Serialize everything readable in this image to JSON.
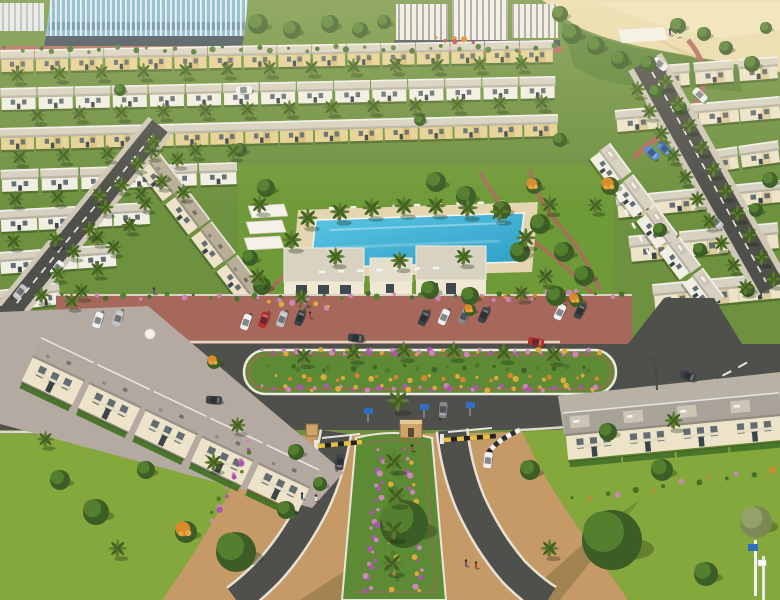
{
  "scene": {
    "label": "aerial-villa-community-render",
    "palette": {
      "sand": "#ead9ab",
      "slope": "#5c8336",
      "lawnBase": "#6e9140",
      "lawnBright": "#85a83d",
      "parkLawn": "#6f9a38",
      "asphalt": "#4f4f4b",
      "brick": "#a5685a",
      "walkRed": "#b06a5e",
      "sidewalk": "#dfd9ca",
      "roadLine": "#eae8de",
      "deck": "#e3d6b0",
      "pool1": "#5cc6e4",
      "pool2": "#2d9ec7",
      "facadeYellow": "#e5d193",
      "facadeCream": "#ece3c8",
      "facadeWhite": "#f1eee3",
      "roofPale": "#d7d1c1",
      "roofGray": "#a9a298",
      "roofTan": "#b9ae96",
      "roofMauve": "#b3a8a0",
      "glass": "#79b2d6",
      "fin": "#eef3f5",
      "winDark": "#55626b",
      "trunk": "#7a6148",
      "palm1": "#5d7c33",
      "palm2": "#42611f",
      "hedge": "#4a762c",
      "flPink": "#cd86bc",
      "flPurple": "#a958ae",
      "flYellow": "#dcab3c",
      "flOrange": "#d8862e",
      "flRed": "#bf4a42",
      "gateYellow": "#e6bf3e",
      "pathTan": "#c69a66",
      "boothTan": "#cfa36a",
      "signBlue": "#2f6fbc",
      "medianGreen": "#5d8a35",
      "carWhite": "#eef0f1",
      "carSilver": "#c0c4c6",
      "carGray": "#85898c",
      "carDark": "#3e4347",
      "carRed": "#b5302d",
      "carBlue": "#4f86d8"
    },
    "rowStyles": {
      "yellow": {
        "roof": "roofPale",
        "facade": "facadeYellow",
        "rh": 10,
        "fh": 12,
        "accent": true
      },
      "white": {
        "roof": "roofPale",
        "facade": "facadeWhite",
        "rh": 10,
        "fh": 12
      },
      "cream": {
        "roof": "roofPale",
        "facade": "facadeCream",
        "rh": 10,
        "fh": 12,
        "accent": true
      },
      "creamBig": {
        "roof": "roofPale",
        "facade": "facadeCream",
        "rh": 12,
        "fh": 14,
        "accent": true
      },
      "tanRow": {
        "roof": "roofTan",
        "facade": "facadeCream",
        "rh": 15,
        "fh": 12,
        "ac": true
      },
      "whiteRow": {
        "roof": "roofPale",
        "facade": "facadeWhite",
        "rh": 14,
        "fh": 12,
        "deck": true
      },
      "villaL": {
        "roof": "roofMauve",
        "facade": "facadeCream",
        "rh": 22,
        "fh": 26,
        "ac": true,
        "balcony": true,
        "hedge": true
      },
      "villaR": {
        "roof": "roofGray",
        "facade": "facadeCream",
        "rh": 24,
        "fh": 24,
        "deck": true,
        "balcony": true,
        "hedge": true
      }
    },
    "housingRows": [
      [
        0,
        60,
        554,
        50,
        34,
        "yellow"
      ],
      [
        648,
        76,
        780,
        66,
        40,
        "cream"
      ],
      [
        0,
        98,
        556,
        86,
        36,
        "white"
      ],
      [
        616,
        120,
        780,
        106,
        42,
        "cream"
      ],
      [
        0,
        138,
        558,
        124,
        35,
        "yellow"
      ],
      [
        698,
        162,
        780,
        150,
        40,
        "cream"
      ],
      [
        0,
        180,
        238,
        172,
        38,
        "white"
      ],
      [
        618,
        206,
        780,
        190,
        44,
        "cream"
      ],
      [
        0,
        220,
        150,
        212,
        38,
        "white"
      ],
      [
        628,
        248,
        780,
        234,
        48,
        "creamBig"
      ],
      [
        0,
        262,
        116,
        254,
        40,
        "white"
      ],
      [
        654,
        296,
        780,
        284,
        44,
        "creamBig"
      ],
      [
        148,
        162,
        276,
        330,
        40,
        "tanRow"
      ],
      [
        598,
        150,
        714,
        306,
        36,
        "whiteRow"
      ],
      [
        0,
        300,
        60,
        292,
        30,
        "white"
      ]
    ],
    "foregroundRows": [
      [
        30,
        356,
        312,
        490,
        58,
        "villaL"
      ],
      [
        566,
        436,
        780,
        416,
        56,
        "villaR"
      ]
    ],
    "palms": [
      [
        16,
        82
      ],
      [
        58,
        80
      ],
      [
        100,
        79
      ],
      [
        142,
        78
      ],
      [
        184,
        77
      ],
      [
        226,
        76
      ],
      [
        268,
        75
      ],
      [
        310,
        74
      ],
      [
        352,
        73
      ],
      [
        394,
        72
      ],
      [
        436,
        72
      ],
      [
        478,
        71
      ],
      [
        520,
        70
      ],
      [
        36,
        122
      ],
      [
        78,
        120
      ],
      [
        120,
        119
      ],
      [
        162,
        118
      ],
      [
        204,
        117
      ],
      [
        246,
        116
      ],
      [
        288,
        115
      ],
      [
        330,
        114
      ],
      [
        372,
        113
      ],
      [
        414,
        112
      ],
      [
        456,
        111
      ],
      [
        498,
        110
      ],
      [
        540,
        109
      ],
      [
        18,
        164
      ],
      [
        62,
        162
      ],
      [
        106,
        160
      ],
      [
        150,
        158
      ],
      [
        194,
        157
      ],
      [
        232,
        158
      ],
      [
        14,
        206
      ],
      [
        56,
        204
      ],
      [
        98,
        202
      ],
      [
        140,
        200
      ],
      [
        182,
        199
      ],
      [
        12,
        248
      ],
      [
        54,
        246
      ],
      [
        96,
        244
      ],
      [
        306,
        226,
        1.2
      ],
      [
        338,
        220,
        1.2
      ],
      [
        370,
        216,
        1.2
      ],
      [
        402,
        214,
        1.2
      ],
      [
        434,
        214,
        1.2
      ],
      [
        466,
        216,
        1.2
      ],
      [
        498,
        220,
        1.2
      ],
      [
        290,
        248,
        1.2
      ],
      [
        524,
        246,
        1.2
      ],
      [
        334,
        264,
        1.1
      ],
      [
        398,
        268,
        1.1
      ],
      [
        462,
        264,
        1.1
      ],
      [
        258,
        212,
        1.1
      ],
      [
        548,
        212,
        1.1
      ],
      [
        256,
        284,
        1.1
      ],
      [
        544,
        284,
        1.1
      ],
      [
        594,
        212
      ],
      [
        302,
        364,
        1.1
      ],
      [
        352,
        360,
        1.1
      ],
      [
        402,
        358,
        1.1
      ],
      [
        452,
        358,
        1.1
      ],
      [
        502,
        360,
        1.1
      ],
      [
        552,
        362,
        1.1
      ],
      [
        392,
        470,
        1.25
      ],
      [
        394,
        504,
        1.25
      ],
      [
        392,
        538,
        1.3
      ],
      [
        390,
        572,
        1.3
      ],
      [
        396,
        410,
        1.35
      ],
      [
        152,
        148
      ],
      [
        136,
        170
      ],
      [
        120,
        192
      ],
      [
        104,
        214
      ],
      [
        88,
        236
      ],
      [
        72,
        258
      ],
      [
        56,
        280
      ],
      [
        40,
        302
      ],
      [
        176,
        166
      ],
      [
        160,
        188
      ],
      [
        144,
        210
      ],
      [
        128,
        232
      ],
      [
        112,
        254
      ],
      [
        96,
        276
      ],
      [
        80,
        298
      ],
      [
        636,
        96
      ],
      [
        648,
        118
      ],
      [
        660,
        140
      ],
      [
        672,
        162
      ],
      [
        684,
        184
      ],
      [
        696,
        206
      ],
      [
        708,
        228
      ],
      [
        720,
        250
      ],
      [
        732,
        272
      ],
      [
        744,
        294
      ],
      [
        664,
        88
      ],
      [
        676,
        110
      ],
      [
        688,
        132
      ],
      [
        700,
        154
      ],
      [
        712,
        176
      ],
      [
        724,
        198
      ],
      [
        736,
        220
      ],
      [
        748,
        242
      ],
      [
        760,
        264
      ],
      [
        772,
        286
      ],
      [
        70,
        308
      ],
      [
        300,
        304
      ],
      [
        520,
        300
      ],
      [
        236,
        432
      ],
      [
        44,
        446
      ],
      [
        212,
        470,
        1.1
      ],
      [
        116,
        556,
        1.1
      ],
      [
        548,
        556,
        1.1
      ],
      [
        672,
        428,
        1.1
      ]
    ],
    "trees": [
      [
        572,
        34,
        10
      ],
      [
        596,
        46,
        9
      ],
      [
        620,
        60,
        9
      ],
      [
        648,
        64,
        8
      ],
      [
        678,
        26,
        8
      ],
      [
        704,
        34,
        7
      ],
      [
        726,
        48,
        7
      ],
      [
        752,
        64,
        8
      ],
      [
        766,
        28,
        6
      ],
      [
        560,
        14,
        8
      ],
      [
        258,
        24,
        10
      ],
      [
        292,
        30,
        9
      ],
      [
        330,
        24,
        9
      ],
      [
        360,
        30,
        8
      ],
      [
        384,
        22,
        7
      ],
      [
        266,
        188,
        9
      ],
      [
        436,
        182,
        10
      ],
      [
        466,
        196,
        10
      ],
      [
        502,
        210,
        9
      ],
      [
        540,
        224,
        10
      ],
      [
        520,
        252,
        10
      ],
      [
        564,
        252,
        10
      ],
      [
        584,
        276,
        10
      ],
      [
        556,
        296,
        10
      ],
      [
        470,
        296,
        9
      ],
      [
        430,
        290,
        9
      ],
      [
        262,
        286,
        9
      ],
      [
        250,
        258,
        8
      ],
      [
        610,
        186,
        9,
        "o"
      ],
      [
        534,
        186,
        8,
        "o"
      ],
      [
        576,
        300,
        7,
        "o"
      ],
      [
        470,
        310,
        6,
        "o"
      ],
      [
        214,
        362,
        7,
        "o"
      ],
      [
        240,
        150,
        7
      ],
      [
        560,
        140,
        7
      ],
      [
        120,
        90,
        6
      ],
      [
        420,
        120,
        6
      ],
      [
        660,
        230,
        7
      ],
      [
        700,
        250,
        7
      ],
      [
        748,
        290,
        7
      ],
      [
        770,
        180,
        8
      ],
      [
        756,
        210,
        7
      ],
      [
        656,
        92,
        7
      ],
      [
        680,
        108,
        7
      ],
      [
        404,
        524,
        24
      ],
      [
        612,
        540,
        30
      ],
      [
        236,
        552,
        20
      ],
      [
        96,
        512,
        13
      ],
      [
        60,
        480,
        10
      ],
      [
        146,
        470,
        9
      ],
      [
        186,
        532,
        11,
        "o"
      ],
      [
        756,
        522,
        16,
        "olive"
      ],
      [
        706,
        574,
        12
      ],
      [
        662,
        470,
        11
      ],
      [
        530,
        470,
        10
      ],
      [
        286,
        510,
        9
      ],
      [
        320,
        484,
        7
      ],
      [
        296,
        452,
        8
      ],
      [
        608,
        432,
        9
      ]
    ],
    "flowerStrips": [
      [
        266,
        352,
        598,
        352,
        44,
        [
          "flPink",
          "flPurple",
          "flPink",
          "flYellow"
        ]
      ],
      [
        272,
        368,
        592,
        368,
        34,
        [
          "#4e7a2e",
          "#5d8a35",
          "#3f6526"
        ]
      ],
      [
        280,
        378,
        596,
        378,
        30,
        [
          "flYellow",
          "flOrange"
        ]
      ],
      [
        266,
        388,
        598,
        388,
        40,
        [
          "flPink",
          "flPurple",
          "flYellow"
        ]
      ],
      [
        382,
        452,
        368,
        592,
        26,
        [
          "flPink",
          "flPurple"
        ]
      ],
      [
        408,
        452,
        420,
        592,
        24,
        [
          "flPurple",
          "flPink",
          "flYellow"
        ]
      ],
      [
        394,
        460,
        394,
        588,
        18,
        [
          "#4e7a2e",
          "flYellow"
        ]
      ],
      [
        252,
        444,
        212,
        520,
        16,
        [
          "flPink",
          "flPurple",
          "#4e7a2e"
        ]
      ],
      [
        66,
        297,
        624,
        295,
        40,
        [
          "#44702a",
          "#558034",
          "flPink"
        ]
      ],
      [
        486,
        300,
        580,
        292,
        12,
        [
          "flOrange",
          "flPink"
        ]
      ],
      [
        262,
        300,
        330,
        308,
        10,
        [
          "flPink",
          "flYellow"
        ]
      ],
      [
        576,
        500,
        770,
        470,
        14,
        [
          "#44702a",
          "flOrange",
          "#44702a",
          "flPink"
        ]
      ],
      [
        8,
        50,
        552,
        48,
        36,
        [
          "#44702a",
          "#558034"
        ]
      ],
      [
        440,
        40,
        470,
        40,
        6,
        [
          "flOrange",
          "flRed"
        ]
      ]
    ],
    "deckItems": [
      [
        332,
        208,
        502,
        202,
        9
      ],
      [
        322,
        272,
        436,
        268,
        7
      ],
      [
        612,
        186,
        648,
        252,
        6
      ]
    ],
    "cars": [
      [
        98,
        320,
        -72,
        "carWhite"
      ],
      [
        118,
        318,
        -72,
        "carSilver"
      ],
      [
        246,
        322,
        -70,
        "carWhite"
      ],
      [
        264,
        320,
        -70,
        "carRed"
      ],
      [
        282,
        319,
        -70,
        "carSilver"
      ],
      [
        300,
        318,
        -70,
        "carDark"
      ],
      [
        424,
        318,
        -66,
        "carDark"
      ],
      [
        444,
        317,
        -66,
        "carWhite"
      ],
      [
        464,
        316,
        -66,
        "carGray"
      ],
      [
        484,
        315,
        -66,
        "carDark"
      ],
      [
        560,
        312,
        -64,
        "carWhite"
      ],
      [
        580,
        311,
        -64,
        "carDark"
      ],
      [
        356,
        338,
        6,
        "carDark"
      ],
      [
        536,
        342,
        10,
        "carRed"
      ],
      [
        214,
        400,
        3,
        "carDark"
      ],
      [
        688,
        376,
        22,
        "carDark"
      ],
      [
        57,
        268,
        128,
        "carWhite"
      ],
      [
        20,
        292,
        128,
        "carSilver"
      ],
      [
        443,
        410,
        95,
        "carGray"
      ],
      [
        340,
        462,
        97,
        "carDark"
      ],
      [
        488,
        460,
        -82,
        "carWhite"
      ],
      [
        652,
        153,
        42,
        "carBlue"
      ],
      [
        665,
        149,
        42,
        "carBlue"
      ],
      [
        700,
        95,
        44,
        "carWhite"
      ],
      [
        716,
        222,
        44,
        "carSilver"
      ],
      [
        660,
        64,
        40,
        "carWhite"
      ],
      [
        244,
        90,
        -4,
        "carWhite"
      ]
    ],
    "people": [
      [
        310,
        316
      ],
      [
        302,
        497
      ],
      [
        316,
        499
      ],
      [
        466,
        564
      ],
      [
        476,
        566
      ],
      [
        670,
        33
      ],
      [
        678,
        35
      ],
      [
        154,
        292
      ],
      [
        412,
        449
      ]
    ]
  }
}
